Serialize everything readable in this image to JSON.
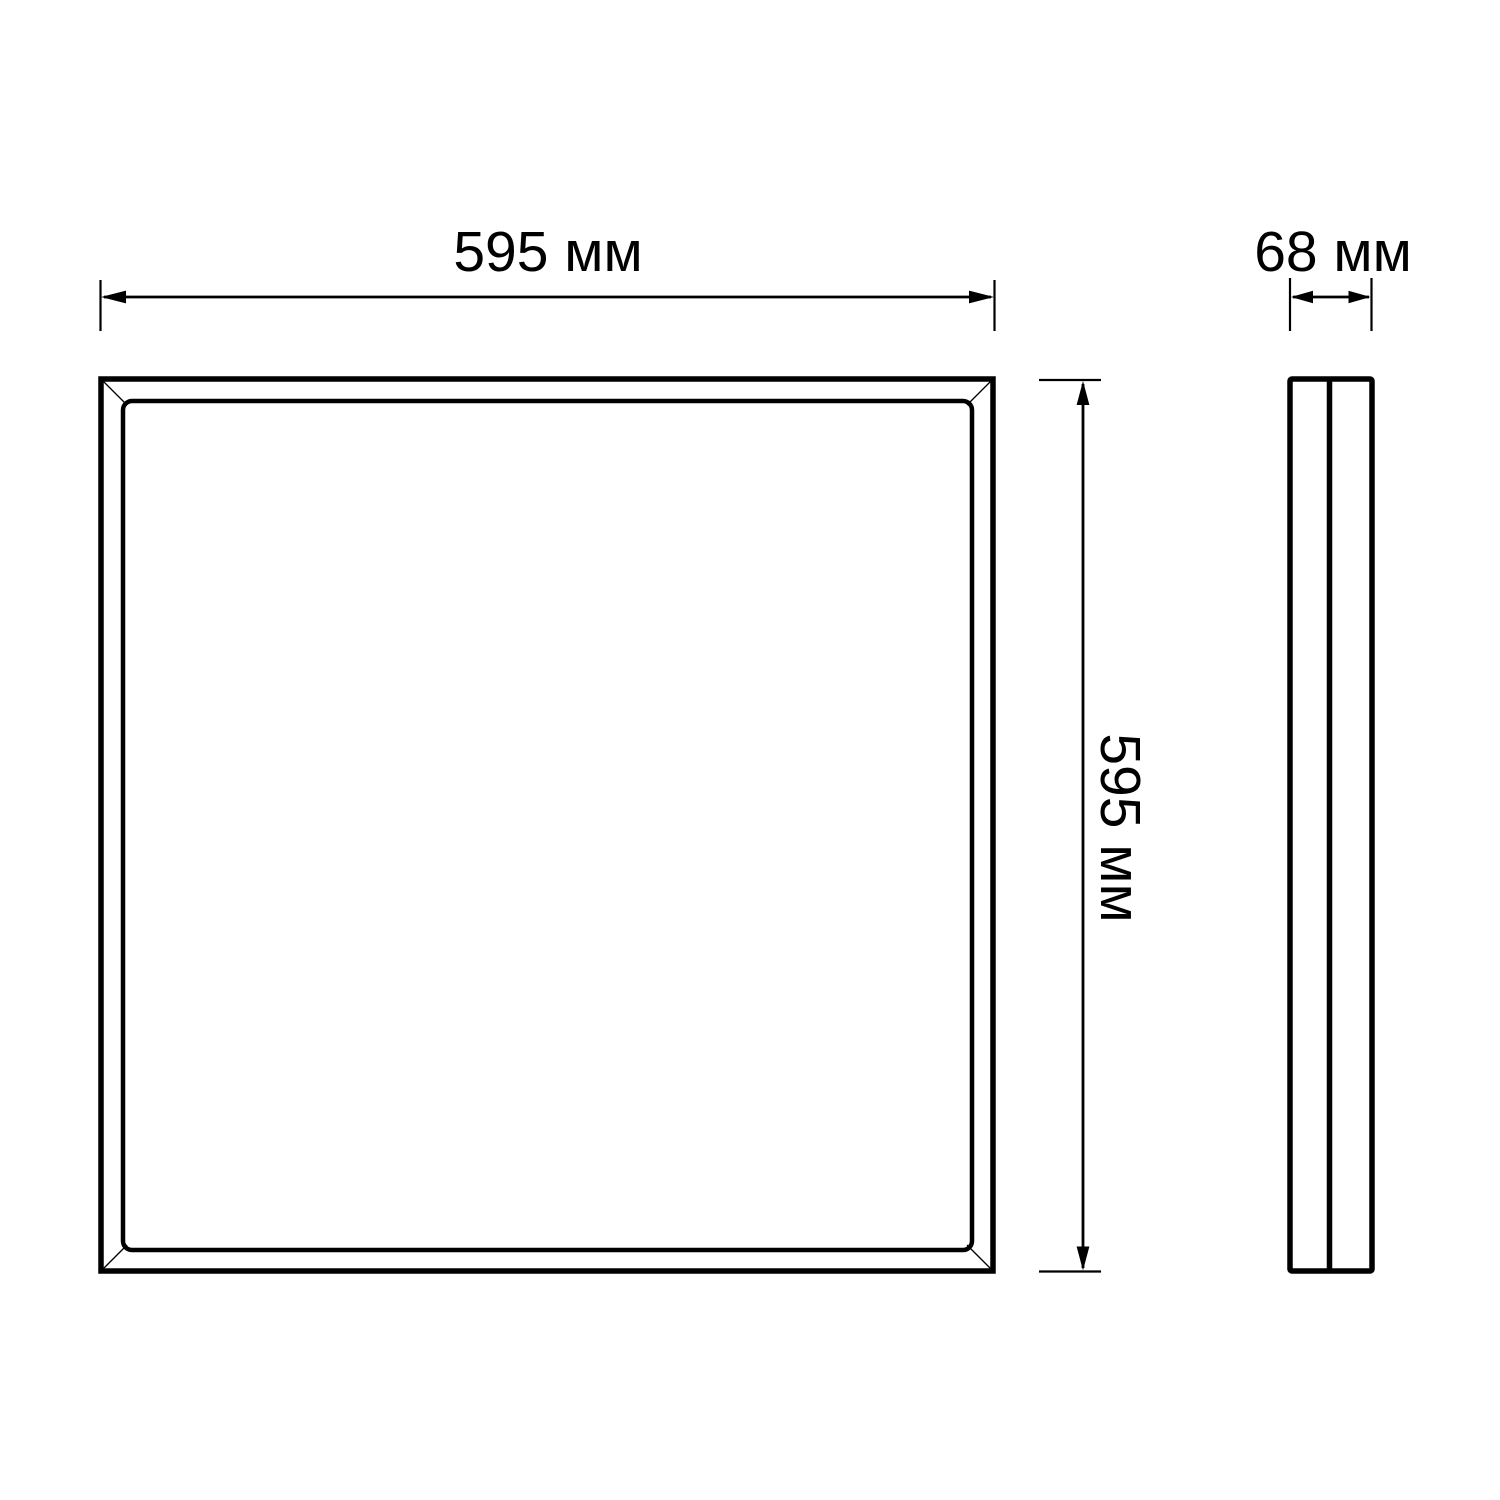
{
  "drawing": {
    "views": {
      "front": {
        "width_dimension": {
          "value": "595",
          "unit": "мм",
          "label": "595 мм"
        },
        "height_dimension": {
          "value": "595",
          "unit": "мм",
          "label": "595 мм"
        }
      },
      "side": {
        "depth_dimension": {
          "value": "68",
          "unit": "мм",
          "label": "68 мм"
        }
      }
    },
    "colors": {
      "line": "#000000",
      "background": "#ffffff"
    }
  }
}
